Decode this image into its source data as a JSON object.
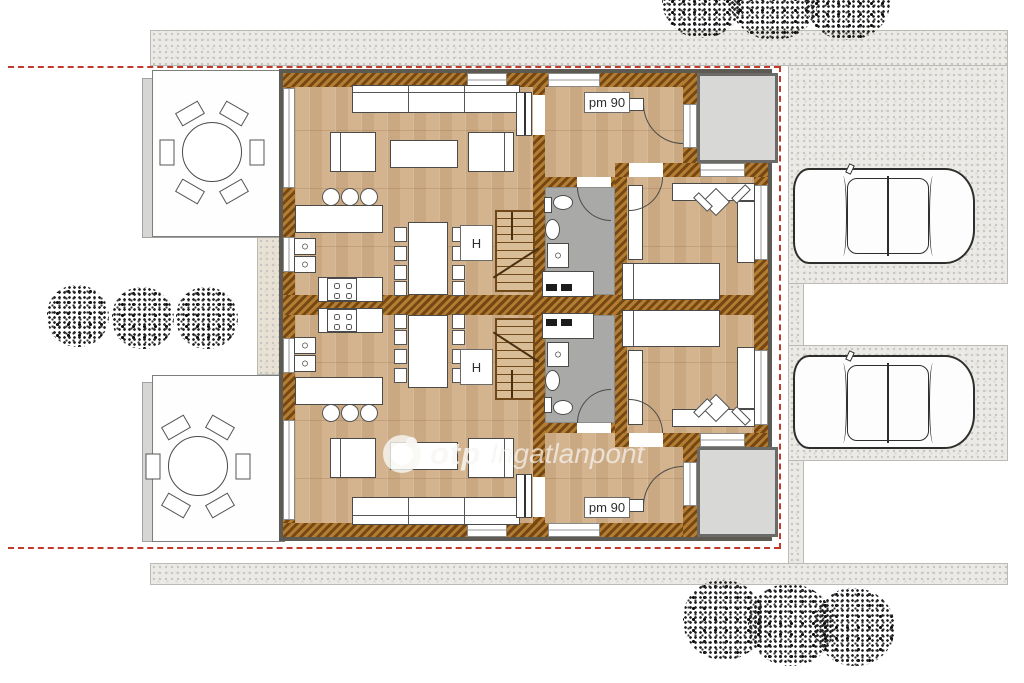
{
  "watermark": {
    "brand": "otp",
    "name": "Ingatlanpont"
  },
  "labels": {
    "entry_door_top": "pm 90",
    "entry_door_bottom": "pm 90",
    "stair_closet_top": "H",
    "stair_closet_bottom": "H"
  },
  "colors": {
    "wall_hatch_light": "#b27c33",
    "wall_hatch_dark": "#744713",
    "wood_floor": "#d3b48f",
    "bathroom_floor": "#a9a9a7",
    "gravel": "#eceae6",
    "porch": "#d8d8d6",
    "boundary_red": "#c0392b",
    "background": "#ffffff"
  },
  "icons": [
    "tree-icon",
    "bush-icon",
    "car-icon",
    "sofa-icon",
    "armchair-icon",
    "coffee-table-icon",
    "dining-table-icon",
    "dining-chair-icon",
    "bar-stool-icon",
    "bar-counter-icon",
    "stove-icon",
    "kitchen-sink-icon",
    "toilet-icon",
    "washbasin-icon",
    "washing-machine-icon",
    "staircase-icon",
    "bed-icon",
    "desk-icon",
    "desk-chair-icon",
    "wardrobe-icon",
    "round-table-icon",
    "terrace-chair-icon",
    "door-swing-arc-icon",
    "window-icon",
    "radiator-icon",
    "otp-logo-icon"
  ]
}
